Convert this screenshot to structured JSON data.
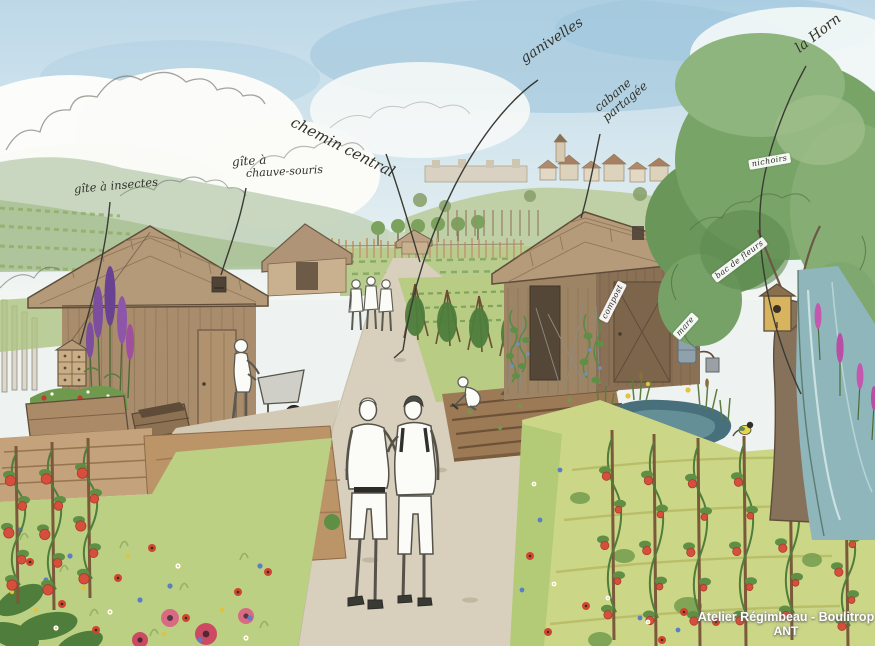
{
  "annotations": {
    "gite_insectes": "gîte à insectes",
    "gite_chauve_souris_line1": "gîte à",
    "gite_chauve_souris_line2": "chauve-souris",
    "chemin_central": "chemin central",
    "ganivelles": "ganivelles",
    "cabane_partagee_line1": "cabane",
    "cabane_partagee_line2": "partagée",
    "la_horn": "la Horn",
    "nichoirs": "nichoirs",
    "compost": "compost",
    "mare": "mare",
    "bac_de_fleurs": "bac de fleurs"
  },
  "credit": {
    "line1": "Atelier Régimbeau - Boulitrop",
    "line2": "ANT"
  },
  "colors": {
    "sky_blue": "#a8cbdf",
    "path_beige": "#d8d0bd",
    "shed_brown": "#a88c6c",
    "roof_brown": "#b49a78",
    "meadow_green": "#bcd083",
    "tree_green": "#79a468",
    "pond_teal": "#48707c",
    "river_teal": "#8fb6ba",
    "tomato_red": "#d5503c",
    "ink": "#3b3b35",
    "label_ribbon_bg": "#ffffff",
    "credit_text": "#ffffff"
  }
}
